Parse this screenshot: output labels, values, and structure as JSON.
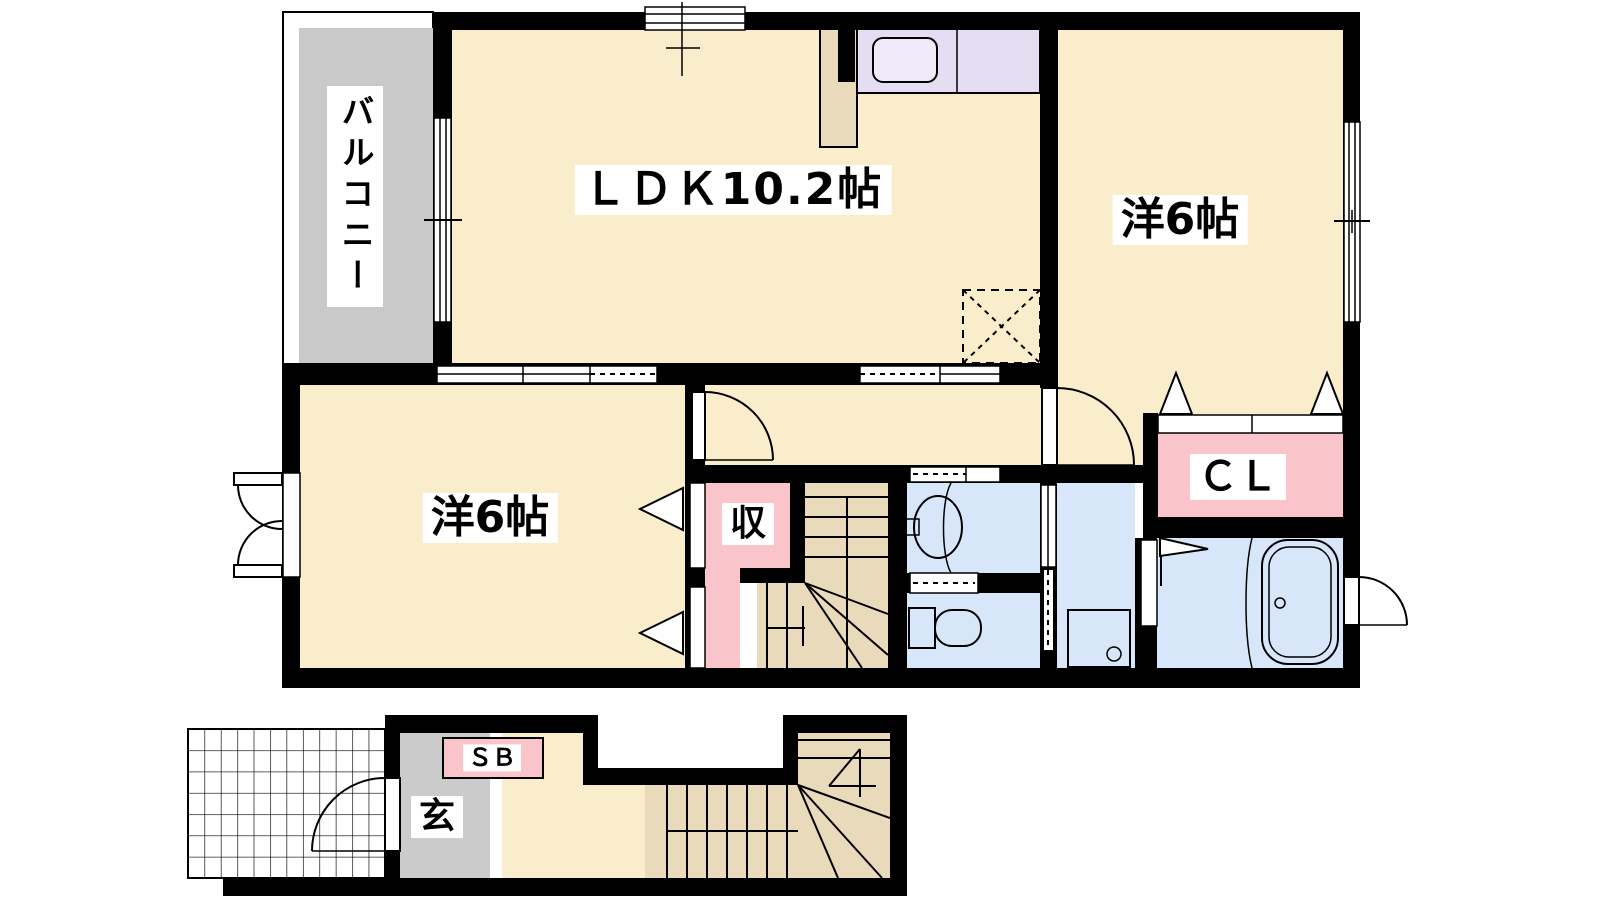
{
  "plan": {
    "type": "apartment-floor-plan",
    "labels": {
      "balcony": "バルコニー",
      "ldk": "ＬＤＫ10.2帖",
      "bedroom_upper": "洋6帖",
      "bedroom_lower": "洋6帖",
      "storage": "収",
      "closet": "ＣＬ",
      "shoe_box": "ＳＢ",
      "entrance": "玄"
    },
    "colors": {
      "room_cream": "#FAEDCB",
      "stairs_tan": "#E8DABB",
      "balcony_gray": "#C9C9C9",
      "genkan_gray": "#CBCBCB",
      "closet_pink": "#F9C5CA",
      "wet_area_blue": "#D7E7F9",
      "kitchen_lavender": "#E5DDF1",
      "sink_fill": "#EFE9F8",
      "wall_black": "#000000",
      "background_white": "#FFFFFF"
    },
    "fixtures": {
      "kitchen_sink": "kitchen-sink",
      "refrigerator_space": "refrigerator-space",
      "washbasin": "washbasin",
      "toilet": "toilet",
      "washing_machine_pan": "washing-machine-pan",
      "bathtub": "bathtub"
    }
  }
}
